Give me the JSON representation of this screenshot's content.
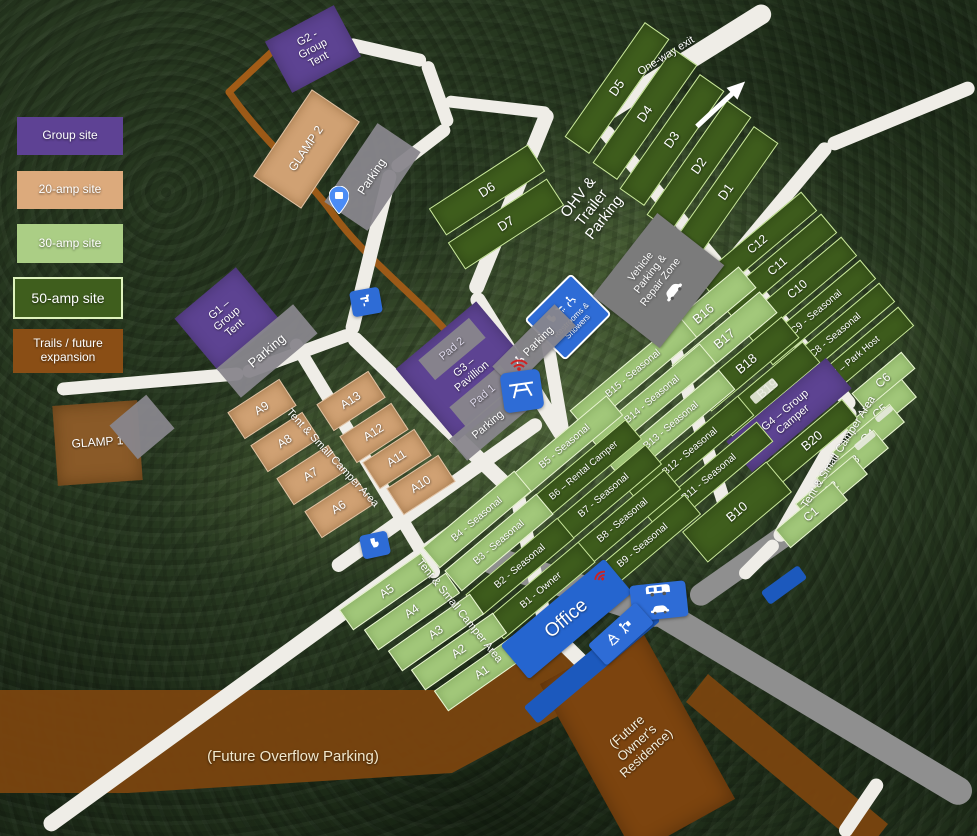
{
  "legend": {
    "items": [
      {
        "label": "Group site"
      },
      {
        "label": "20-amp site"
      },
      {
        "label": "30-amp site"
      },
      {
        "label": "50-amp site"
      },
      {
        "label": "Trails / future\nexpansion"
      }
    ]
  },
  "signs": {
    "office": "Office",
    "restrooms": "Restrooms & Showers",
    "vehicle_zone": "Vehicle\nParking &\nRepair Zone",
    "parking_accessible": "Parking"
  },
  "colors": {
    "group_site": "#5e4294",
    "amp20_site": "#d0a173",
    "amp30_site": "#a2c87a",
    "amp50_site": "#3f5e1d",
    "trail_brown": "#7c440f",
    "road_white": "#efede7",
    "road_gray": "#8f8f8f",
    "sign_blue": "#2e6cd6",
    "forest_green": "#26371f"
  },
  "icons": [
    "map-pin-icon",
    "water-spigot-icon",
    "toilet-icon",
    "picnic-table-icon",
    "wifi-icon",
    "wheelchair-icon",
    "shower-icon",
    "car-icon",
    "rv-camper-icon",
    "recycle-icon",
    "trash-person-icon",
    "one-way-arrow-icon"
  ],
  "features": [
    {
      "id": "site-d5",
      "k": "t50",
      "x": 617,
      "y": 88,
      "w": 140,
      "h": 30,
      "r": -55,
      "fs": 13,
      "label": "D5"
    },
    {
      "id": "site-d4",
      "k": "t50",
      "x": 645,
      "y": 114,
      "w": 140,
      "h": 30,
      "r": -55,
      "fs": 13,
      "label": "D4"
    },
    {
      "id": "site-d3",
      "k": "t50",
      "x": 672,
      "y": 140,
      "w": 140,
      "h": 30,
      "r": -55,
      "fs": 13,
      "label": "D3"
    },
    {
      "id": "site-d2",
      "k": "t50",
      "x": 699,
      "y": 166,
      "w": 140,
      "h": 30,
      "r": -55,
      "fs": 13,
      "label": "D2"
    },
    {
      "id": "site-d1",
      "k": "t50",
      "x": 726,
      "y": 192,
      "w": 140,
      "h": 30,
      "r": -55,
      "fs": 13,
      "label": "D1"
    },
    {
      "id": "site-d6",
      "k": "t50",
      "x": 487,
      "y": 190,
      "w": 118,
      "h": 32,
      "r": -33,
      "fs": 13,
      "label": "D6"
    },
    {
      "id": "site-d7",
      "k": "t50",
      "x": 506,
      "y": 224,
      "w": 118,
      "h": 32,
      "r": -33,
      "fs": 13,
      "label": "D7"
    },
    {
      "id": "site-c12",
      "k": "t50",
      "x": 757,
      "y": 244,
      "w": 135,
      "h": 25,
      "r": -40,
      "fs": 12,
      "label": "C12"
    },
    {
      "id": "site-c11",
      "k": "t50",
      "x": 777,
      "y": 266,
      "w": 135,
      "h": 25,
      "r": -40,
      "fs": 12,
      "label": "C11"
    },
    {
      "id": "site-c10",
      "k": "t50",
      "x": 797,
      "y": 289,
      "w": 135,
      "h": 25,
      "r": -40,
      "fs": 12,
      "label": "C10"
    },
    {
      "id": "site-c9",
      "k": "t50",
      "x": 816,
      "y": 312,
      "w": 135,
      "h": 25,
      "r": -40,
      "fs": 10,
      "label": "C9 - Seasonal"
    },
    {
      "id": "site-c8",
      "k": "t50",
      "x": 835,
      "y": 335,
      "w": 135,
      "h": 25,
      "r": -40,
      "fs": 10,
      "label": "C8 - Seasonal"
    },
    {
      "id": "site-c7",
      "k": "t50",
      "x": 854,
      "y": 359,
      "w": 135,
      "h": 25,
      "r": -40,
      "fs": 9.5,
      "label": "C7 – Park Host"
    },
    {
      "id": "site-c6",
      "k": "t30",
      "x": 883,
      "y": 381,
      "w": 65,
      "h": 22,
      "r": -40,
      "fs": 12,
      "label": "C6"
    },
    {
      "id": "site-c5",
      "k": "t30",
      "x": 880,
      "y": 412,
      "w": 75,
      "h": 24,
      "r": -40,
      "fs": 12,
      "label": "C5"
    },
    {
      "id": "site-c4",
      "k": "t30",
      "x": 868,
      "y": 437,
      "w": 75,
      "h": 24,
      "r": -40,
      "fs": 12,
      "label": "C4"
    },
    {
      "id": "site-c3",
      "k": "t30",
      "x": 852,
      "y": 463,
      "w": 75,
      "h": 24,
      "r": -40,
      "fs": 12,
      "label": "C3"
    },
    {
      "id": "site-c2",
      "k": "t30",
      "x": 831,
      "y": 489,
      "w": 75,
      "h": 24,
      "r": -40,
      "fs": 12,
      "label": "C2"
    },
    {
      "id": "site-c1",
      "k": "t30",
      "x": 811,
      "y": 515,
      "w": 75,
      "h": 24,
      "r": -40,
      "fs": 12,
      "label": "C1"
    },
    {
      "id": "site-b16",
      "k": "t30",
      "x": 703,
      "y": 314,
      "w": 115,
      "h": 28,
      "r": -40,
      "fs": 13,
      "label": "B16"
    },
    {
      "id": "site-b17",
      "k": "t30",
      "x": 724,
      "y": 339,
      "w": 115,
      "h": 28,
      "r": -40,
      "fs": 13,
      "label": "B17"
    },
    {
      "id": "site-b18",
      "k": "t50",
      "x": 746,
      "y": 364,
      "w": 115,
      "h": 28,
      "r": -40,
      "fs": 13,
      "label": "B18"
    },
    {
      "id": "site-b19",
      "k": "t50",
      "x": 767,
      "y": 389,
      "w": 115,
      "h": 28,
      "r": -40,
      "fs": 13,
      "label": "B19"
    },
    {
      "id": "site-g4",
      "k": "g",
      "x": 789,
      "y": 415,
      "w": 130,
      "h": 40,
      "r": -40,
      "fs": 11,
      "label": "G4 – Group\nCamper"
    },
    {
      "id": "site-b20",
      "k": "t50",
      "x": 812,
      "y": 441,
      "w": 100,
      "h": 26,
      "r": -40,
      "fs": 13,
      "label": "B20"
    },
    {
      "id": "site-b15",
      "k": "t30",
      "x": 633,
      "y": 374,
      "w": 145,
      "h": 26,
      "r": -40,
      "fs": 10,
      "label": "B15 - Seasonal"
    },
    {
      "id": "site-b14",
      "k": "t30",
      "x": 652,
      "y": 400,
      "w": 145,
      "h": 26,
      "r": -40,
      "fs": 10,
      "label": "B14 - Seasonal"
    },
    {
      "id": "site-b13",
      "k": "t30",
      "x": 671,
      "y": 426,
      "w": 145,
      "h": 26,
      "r": -40,
      "fs": 10,
      "label": "B13 - Seasonal"
    },
    {
      "id": "site-b12",
      "k": "t50",
      "x": 690,
      "y": 452,
      "w": 145,
      "h": 26,
      "r": -40,
      "fs": 10,
      "label": "B12 - Seasonal"
    },
    {
      "id": "site-b11",
      "k": "t50",
      "x": 709,
      "y": 478,
      "w": 145,
      "h": 26,
      "r": -40,
      "fs": 10,
      "label": "B11 - Seasonal"
    },
    {
      "id": "site-b10",
      "k": "t50",
      "x": 737,
      "y": 512,
      "w": 110,
      "h": 40,
      "r": -40,
      "fs": 13,
      "label": "B10"
    },
    {
      "id": "site-b5",
      "k": "t30",
      "x": 565,
      "y": 447,
      "w": 130,
      "h": 26,
      "r": -40,
      "fs": 10,
      "label": "B5 - Seasonal"
    },
    {
      "id": "site-b6",
      "k": "t50",
      "x": 584,
      "y": 471,
      "w": 130,
      "h": 26,
      "r": -40,
      "fs": 9.5,
      "label": "B6 – Rental Camper"
    },
    {
      "id": "site-b7",
      "k": "t50",
      "x": 604,
      "y": 496,
      "w": 130,
      "h": 26,
      "r": -40,
      "fs": 10,
      "label": "B7 - Seasonal"
    },
    {
      "id": "site-b8",
      "k": "t50",
      "x": 623,
      "y": 521,
      "w": 130,
      "h": 26,
      "r": -40,
      "fs": 10,
      "label": "B8 - Seasonal"
    },
    {
      "id": "site-b9",
      "k": "t50",
      "x": 643,
      "y": 546,
      "w": 130,
      "h": 26,
      "r": -40,
      "fs": 10,
      "label": "B9 - Seasonal"
    },
    {
      "id": "site-b4",
      "k": "t30",
      "x": 477,
      "y": 519,
      "w": 120,
      "h": 27,
      "r": -40,
      "fs": 10,
      "label": "B4 - Seasonal"
    },
    {
      "id": "site-b3",
      "k": "t30",
      "x": 499,
      "y": 542,
      "w": 120,
      "h": 27,
      "r": -40,
      "fs": 10,
      "label": "B3 - Seasonal"
    },
    {
      "id": "site-b2",
      "k": "t50",
      "x": 520,
      "y": 566,
      "w": 120,
      "h": 27,
      "r": -40,
      "fs": 10,
      "label": "B2 - Seasonal"
    },
    {
      "id": "site-b1",
      "k": "t50",
      "x": 541,
      "y": 590,
      "w": 120,
      "h": 27,
      "r": -40,
      "fs": 10,
      "label": "B1 - Owner"
    },
    {
      "id": "site-a9",
      "k": "t20",
      "x": 262,
      "y": 409,
      "w": 62,
      "h": 32,
      "r": -33,
      "fs": 12,
      "label": "A9"
    },
    {
      "id": "site-a8",
      "k": "t20",
      "x": 285,
      "y": 442,
      "w": 62,
      "h": 32,
      "r": -33,
      "fs": 12,
      "label": "A8"
    },
    {
      "id": "site-a7",
      "k": "t20",
      "x": 311,
      "y": 475,
      "w": 62,
      "h": 32,
      "r": -33,
      "fs": 12,
      "label": "A7"
    },
    {
      "id": "site-a6",
      "k": "t20",
      "x": 339,
      "y": 508,
      "w": 62,
      "h": 32,
      "r": -33,
      "fs": 12,
      "label": "A6"
    },
    {
      "id": "site-a13",
      "k": "t20",
      "x": 351,
      "y": 401,
      "w": 62,
      "h": 32,
      "r": -33,
      "fs": 12,
      "label": "A13"
    },
    {
      "id": "site-a12",
      "k": "t20",
      "x": 374,
      "y": 433,
      "w": 62,
      "h": 32,
      "r": -33,
      "fs": 12,
      "label": "A12"
    },
    {
      "id": "site-a11",
      "k": "t20",
      "x": 397,
      "y": 459,
      "w": 62,
      "h": 32,
      "r": -33,
      "fs": 12,
      "label": "A11"
    },
    {
      "id": "site-a10",
      "k": "t20",
      "x": 421,
      "y": 485,
      "w": 62,
      "h": 32,
      "r": -33,
      "fs": 12,
      "label": "A10"
    },
    {
      "id": "site-a5",
      "k": "t30",
      "x": 387,
      "y": 591,
      "w": 100,
      "h": 25,
      "r": -35,
      "fs": 12,
      "label": "A5"
    },
    {
      "id": "site-a4",
      "k": "t30",
      "x": 412,
      "y": 611,
      "w": 100,
      "h": 25,
      "r": -35,
      "fs": 12,
      "label": "A4"
    },
    {
      "id": "site-a3",
      "k": "t30",
      "x": 436,
      "y": 632,
      "w": 100,
      "h": 25,
      "r": -35,
      "fs": 12,
      "label": "A3"
    },
    {
      "id": "site-a2",
      "k": "t30",
      "x": 459,
      "y": 651,
      "w": 100,
      "h": 25,
      "r": -35,
      "fs": 12,
      "label": "A2"
    },
    {
      "id": "site-a1",
      "k": "t30",
      "x": 482,
      "y": 672,
      "w": 100,
      "h": 25,
      "r": -35,
      "fs": 12,
      "label": "A1"
    },
    {
      "id": "site-g2",
      "k": "g",
      "x": 313,
      "y": 49,
      "w": 78,
      "h": 58,
      "r": -28,
      "fs": 11,
      "label": "G2 -\nGroup\nTent"
    },
    {
      "id": "site-g1",
      "k": "g",
      "x": 227,
      "y": 319,
      "w": 80,
      "h": 68,
      "r": -40,
      "fs": 11,
      "label": "G1 –\nGroup\nTent"
    },
    {
      "id": "site-g3-zone",
      "k": "g",
      "x": 466,
      "y": 371,
      "w": 105,
      "h": 95,
      "r": -40,
      "fs": 11,
      "label": ""
    },
    {
      "id": "pad-2",
      "k": "pad",
      "x": 452,
      "y": 349,
      "w": 66,
      "h": 26,
      "r": -40,
      "fs": 11,
      "label": "Pad 2",
      "c": "#ddd8ea"
    },
    {
      "id": "pad-1",
      "k": "pad",
      "x": 483,
      "y": 396,
      "w": 66,
      "h": 26,
      "r": -40,
      "fs": 11,
      "label": "Pad 1",
      "c": "#ddd8ea"
    },
    {
      "id": "label-g3-pavilion",
      "k": "label",
      "x": 468,
      "y": 372,
      "w": 90,
      "h": 32,
      "r": -40,
      "fs": 11,
      "label": "G3 –\nPavillion"
    },
    {
      "id": "site-glamp2",
      "k": "t20",
      "x": 306,
      "y": 149,
      "w": 105,
      "h": 58,
      "r": -56,
      "fs": 12,
      "label": "GLAMP 2"
    },
    {
      "id": "parking-glamp2",
      "k": "pad",
      "x": 372,
      "y": 177,
      "w": 95,
      "h": 52,
      "r": -56,
      "fs": 12,
      "label": "Parking"
    },
    {
      "id": "site-glamp1",
      "k": "brown2",
      "x": 97,
      "y": 443,
      "w": 85,
      "h": 80,
      "r": -4,
      "fs": 12,
      "label": "GLAMP 1"
    },
    {
      "id": "parking-glamp1",
      "k": "pad",
      "x": 142,
      "y": 427,
      "w": 48,
      "h": 44,
      "r": -40,
      "fs": 11,
      "label": ""
    },
    {
      "id": "parking-g1",
      "k": "pad",
      "x": 267,
      "y": 351,
      "w": 100,
      "h": 38,
      "r": -40,
      "fs": 13,
      "label": "Parking"
    },
    {
      "id": "parking-pavilion",
      "k": "pad",
      "x": 488,
      "y": 425,
      "w": 78,
      "h": 28,
      "r": -40,
      "fs": 11,
      "label": "Parking"
    },
    {
      "id": "label-ohv",
      "k": "label",
      "x": 592,
      "y": 208,
      "w": 130,
      "h": 64,
      "r": -52,
      "fs": 15,
      "label": "OHV &\nTrailer\nParking"
    },
    {
      "id": "label-one-way-exit",
      "k": "label",
      "x": 666,
      "y": 56,
      "w": 120,
      "h": 16,
      "r": -32,
      "fs": 11,
      "label": "One-way exit"
    },
    {
      "id": "label-tent-area-west",
      "k": "label",
      "x": 332,
      "y": 458,
      "w": 175,
      "h": 16,
      "r": 47,
      "fs": 11,
      "label": "Tent & Small Camper Area"
    },
    {
      "id": "label-tent-area-south",
      "k": "label",
      "x": 459,
      "y": 611,
      "w": 175,
      "h": 16,
      "r": 51,
      "fs": 11,
      "label": "Tent & Small Camper Area"
    },
    {
      "id": "label-tent-area-east",
      "k": "label",
      "x": 838,
      "y": 452,
      "w": 175,
      "h": 16,
      "r": -58,
      "fs": 11,
      "label": "Tent & Small Camper Area"
    },
    {
      "id": "label-future-overflow-parking",
      "k": "label",
      "x": 293,
      "y": 757,
      "w": 330,
      "h": 24,
      "r": 0,
      "fs": 15,
      "label": "(Future Overflow Parking)",
      "c": "#f2e8cd"
    },
    {
      "id": "area-future-owners-residence",
      "k": "brown",
      "x": 637,
      "y": 741,
      "w": 115,
      "h": 195,
      "r": -29,
      "fs": 11,
      "label": ""
    },
    {
      "id": "label-future-owners-residence",
      "k": "label",
      "x": 637,
      "y": 743,
      "w": 130,
      "h": 66,
      "r": -42,
      "fs": 13,
      "label": "(Future\nOwner's\nResidence)",
      "c": "#f5efdd"
    },
    {
      "id": "office-dump-strip",
      "k": "blue2",
      "x": 592,
      "y": 664,
      "w": 160,
      "h": 22,
      "r": -40,
      "fs": 10,
      "label": ""
    },
    {
      "id": "small-blue-sign",
      "k": "blue2",
      "x": 784,
      "y": 585,
      "w": 46,
      "h": 16,
      "r": -36,
      "fs": 10,
      "label": ""
    },
    {
      "id": "camper-c4",
      "k": "camper",
      "x": 865,
      "y": 440,
      "w": 24,
      "h": 7,
      "r": -40,
      "fs": 8,
      "label": ""
    },
    {
      "id": "camper-c5",
      "k": "camper",
      "x": 884,
      "y": 414,
      "w": 20,
      "h": 6,
      "r": -40,
      "fs": 8,
      "label": ""
    },
    {
      "id": "camper-b19",
      "k": "camper",
      "x": 764,
      "y": 391,
      "w": 30,
      "h": 10,
      "r": -40,
      "fs": 8,
      "label": ""
    }
  ]
}
